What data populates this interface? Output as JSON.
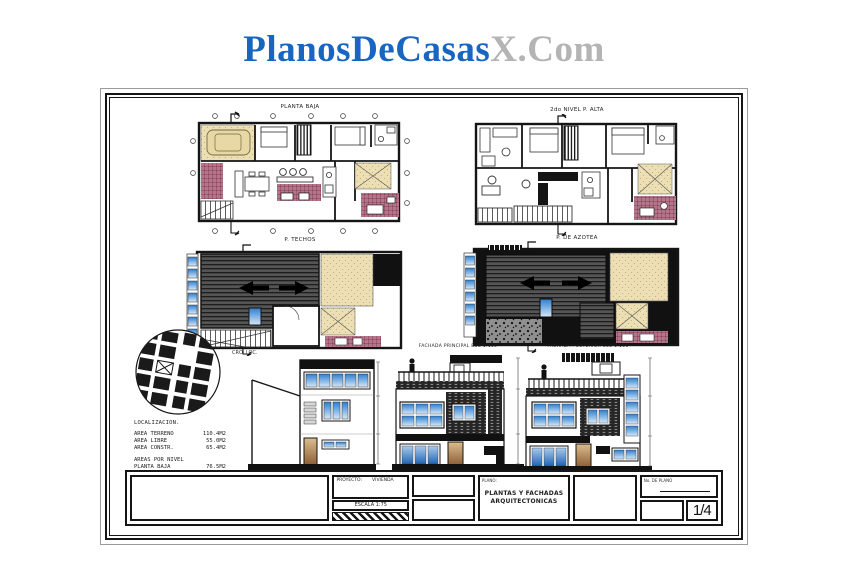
{
  "brand": {
    "primary": "PlanosDeCasas",
    "suffix": "X.Com"
  },
  "colors": {
    "brand_blue": "#1766c2",
    "brand_gray": "#b4b4b4",
    "wall_black": "#151515",
    "tile_maroon": "#8c3b55",
    "terrace_tan": "#ecdfb4",
    "roof_gray": "#4f4f4f",
    "glass_blue": "#3d86d8"
  },
  "sheet": {
    "plans": [
      {
        "id": "planta-baja",
        "title": "PLANTA BAJA"
      },
      {
        "id": "planta-alta",
        "title": "2do NIVEL P. ALTA"
      },
      {
        "id": "planta-techos",
        "title": "P. TECHOS"
      },
      {
        "id": "planta-azotea",
        "title": "P. DE AZOTEA"
      }
    ],
    "elevations": [
      {
        "id": "fachada-lateral",
        "title": ""
      },
      {
        "id": "fachada-principal",
        "title": "FACHADA PRINCIPAL ESC 1:100"
      },
      {
        "id": "fachada-posterior",
        "title": "FACHADA POSTERIOR ESC 1:100"
      }
    ],
    "location": {
      "caption": "CRO. LOC.",
      "header": "LOCALIZACION.",
      "areas": [
        {
          "label": "AREA TERRENO",
          "value": "110.4M2"
        },
        {
          "label": "AREA LIBRE",
          "value": "55.0M2"
        },
        {
          "label": "AREA CONSTR.",
          "value": "65.4M2"
        }
      ],
      "levels_header": "AREAS POR NIVEL",
      "levels": [
        {
          "label": "PLANTA BAJA",
          "value": "76.5M2"
        },
        {
          "label": "PLANTA ALTA",
          "value": "53.7M2"
        }
      ]
    },
    "titleblock": {
      "project_label": "PROYECTO:",
      "project_value": "VIVIENDA",
      "scale_label": "ESCALA 1:75",
      "plano_label": "PLANO:",
      "title_line1": "PLANTAS Y FACHADAS",
      "title_line2": "ARQUITECTONICAS",
      "number_label": "No. DE PLANO",
      "page_number": "1/4"
    }
  }
}
